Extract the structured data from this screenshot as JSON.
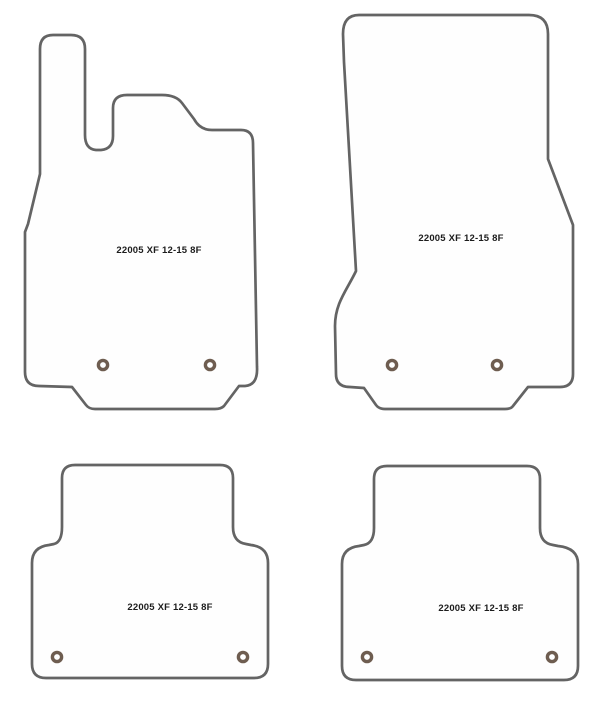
{
  "page": {
    "background": "#ffffff",
    "description_label": "car-floor-mat-template-set"
  },
  "colors": {
    "outline": "#646464",
    "mat_fill": "#fefefe",
    "eyelet_ring": "#6e5d50",
    "label_text": "#1c1c1c"
  },
  "mats": {
    "front_left": {
      "label": "22005 XF 12-15 8F"
    },
    "front_right": {
      "label": "22005 XF 12-15 8F"
    },
    "rear_left": {
      "label": "22005 XF 12-15 8F"
    },
    "rear_right": {
      "label": "22005 XF 12-15 8F"
    }
  }
}
